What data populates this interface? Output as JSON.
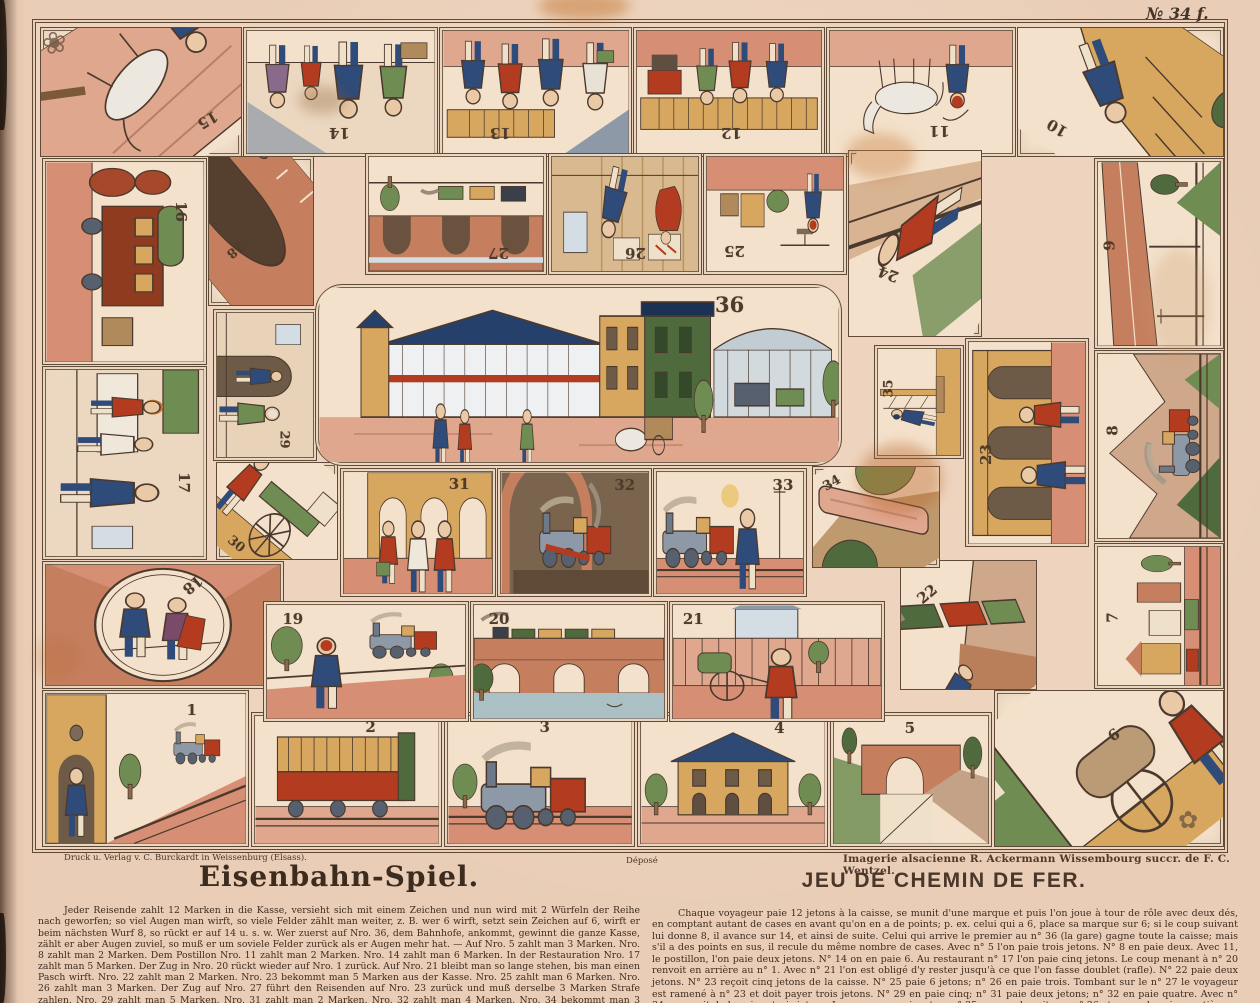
{
  "plate": {
    "number_tag": "№ 34 f.",
    "imprint_left": "Druck u. Verlag v. C. Burckardt in Weissenburg (Elsass).",
    "depose": "Déposé",
    "imprint_right": "Imagerie alsacienne R. Ackermann Wissembourg succr. de F. C. Wentzel."
  },
  "titles": {
    "german": "Eisenbahn-Spiel.",
    "french": "JEU DE CHEMIN DE FER."
  },
  "rules": {
    "german": "Jeder Reisende zahlt 12 Marken in die Kasse, versieht sich mit einem Zeichen und nun wird mit 2 Würfeln der Reihe nach geworfen; so viel Augen man wirft, so viele Felder zählt man weiter, z. B. wer 6 wirft, setzt sein Zeichen auf 6, wirft er beim nächsten Wurf 8, so rückt er auf 14 u. s. w. Wer zuerst auf Nro. 36, dem Bahnhofe, ankommt, gewinnt die ganze Kasse, zählt er aber Augen zuviel, so muß er um soviele Felder zurück als er Augen mehr hat. — Auf Nro. 5 zahlt man 3 Marken. Nro. 8 zahlt man 2 Marken. Dem Postillon Nro. 11 zahlt man 2 Marken. Nro. 14 zahlt man 6 Marken. In der Restauration Nro. 17 zahlt man 5 Marken. Der Zug in Nro. 20 rückt wieder auf Nro. 1 zurück. Auf Nro. 21 bleibt man so lange stehen, bis man einen Pasch wirft. Nro. 22 zahlt man 2 Marken. Nro. 23 bekommt man 5 Marken aus der Kasse. Nro. 25 zahlt man 6 Marken. Nro. 26 zahlt man 3 Marken. Der Zug auf Nro. 27 führt den Reisenden auf Nro. 23 zurück und muß derselbe 3 Marken Strafe zahlen. Nro. 29 zahlt man 5 Marken. Nro. 31 zahlt man 2 Marken. Nro. 32 zahlt man 4 Marken. Nro. 34 bekommt man 3 Marken aus der Kasse. Kommt der Passagier auf Nro. 35, so rückt er gleich nach Nro. 36 und hat dann die ganze Kasse gewonnen.",
    "french": "Chaque voyageur paie 12 jetons à la caisse, se munit d'une marque et puis l'on joue à tour de rôle avec deux dés, en comptant autant de cases en avant qu'on en a de points; p. ex. celui qui a 6, place sa marque sur 6; si le coup suivant lui donne 8, il avance sur 14, et ainsi de suite. Celui qui arrive le premier au n° 36 (la gare) gagne toute la caisse; mais s'il a des points en sus, il recule du même nombre de cases. Avec n° 5 l'on paie trois jetons. N° 8 en paie deux. Avec 11, le postillon, l'on paie deux jetons. N° 14 on en paie 6. Au restaurant n° 17 l'on paie cinq jetons. Le coup menant à n° 20 renvoit en arrière au n° 1. Avec n° 21 l'on est obligé d'y rester jusqu'à ce que l'on fasse doublet (rafle). N° 22 paie deux jetons. N° 23 reçoit cinq jetons de la caisse. N° 25 paie 6 jetons; n° 26 en paie trois. Tombant sur le n° 27 le voyageur est ramené à n° 23 et doit payer trois jetons. N° 29 en paie cinq; n° 31 paie deux jetons; n° 32 en paie quatre. Avec n° 34 on reçoit de la caisse trois jetons. Le voyageur arrivant au n° 35 avance de suite au n° 36 et gagne la caisse entière."
  },
  "board": {
    "cells": [
      {
        "number": 1,
        "scene": "station-bell-ringer"
      },
      {
        "number": 2,
        "scene": "passenger-carriage"
      },
      {
        "number": 3,
        "scene": "locomotive"
      },
      {
        "number": 4,
        "scene": "station-building"
      },
      {
        "number": 5,
        "scene": "stone-bridge"
      },
      {
        "number": 6,
        "scene": "barrel-handcart"
      },
      {
        "number": 7,
        "scene": "town-railway"
      },
      {
        "number": 8,
        "scene": "mountain-cutting-train"
      },
      {
        "number": 9,
        "scene": "trackside-wall"
      },
      {
        "number": 10,
        "scene": "embankment-fall"
      },
      {
        "number": 11,
        "scene": "postillion-horse"
      },
      {
        "number": 12,
        "scene": "ticket-barrier"
      },
      {
        "number": 13,
        "scene": "travellers-walking"
      },
      {
        "number": 14,
        "scene": "family-farewell"
      },
      {
        "number": 15,
        "scene": "horse-accident"
      },
      {
        "number": 16,
        "scene": "freight-wagon"
      },
      {
        "number": 17,
        "scene": "station-buffet"
      },
      {
        "number": 18,
        "scene": "platform-greeting"
      },
      {
        "number": 19,
        "scene": "boy-watching-train"
      },
      {
        "number": 20,
        "scene": "viaduct-river-train"
      },
      {
        "number": 21,
        "scene": "boy-with-handcart"
      },
      {
        "number": 22,
        "scene": "train-derailment"
      },
      {
        "number": 23,
        "scene": "carriage-boarding"
      },
      {
        "number": 24,
        "scene": "man-fallen-on-tracks"
      },
      {
        "number": 25,
        "scene": "goods-weighing"
      },
      {
        "number": 26,
        "scene": "ticket-office"
      },
      {
        "number": 27,
        "scene": "arched-viaduct-train"
      },
      {
        "number": 28,
        "scene": "tunnel-portal"
      },
      {
        "number": 29,
        "scene": "station-doorway"
      },
      {
        "number": 30,
        "scene": "porter-luggage-cart"
      },
      {
        "number": 31,
        "scene": "arcade-travellers"
      },
      {
        "number": 32,
        "scene": "engine-shed"
      },
      {
        "number": 33,
        "scene": "man-beside-locomotive"
      },
      {
        "number": 34,
        "scene": "fallen-signal-mast"
      },
      {
        "number": 35,
        "scene": "signal-climber"
      },
      {
        "number": 36,
        "scene": "central-railway-station"
      }
    ]
  },
  "colors": {
    "paper": "#e9cdb6",
    "cell": "#f5e3cd",
    "ink": "#4b392d",
    "salmon": "#dfa28c",
    "red": "#b33b20",
    "blue": "#2f4b79",
    "green": "#6f8d53",
    "tan": "#d8a75f",
    "brick": "#c57f5f"
  }
}
